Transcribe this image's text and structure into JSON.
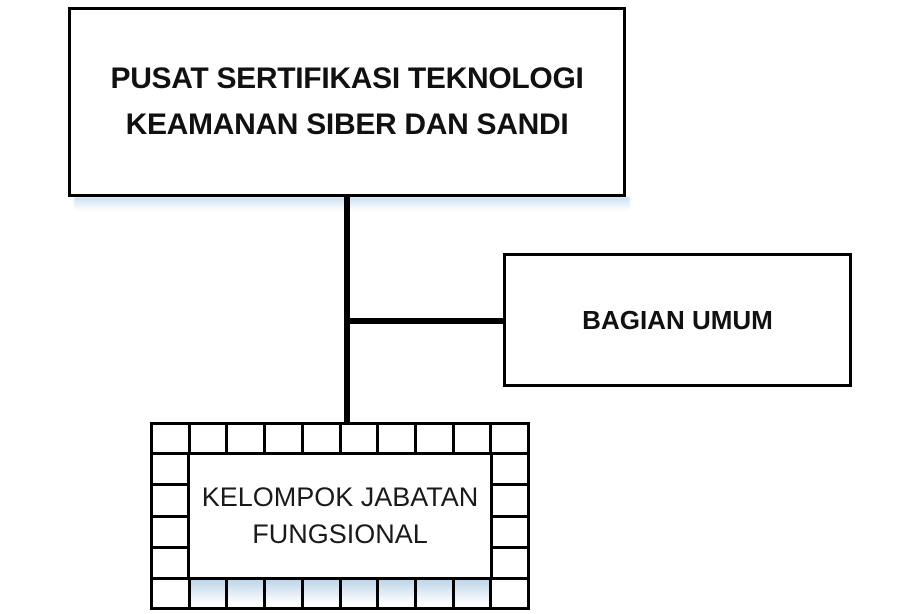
{
  "nodes": {
    "root": {
      "line1": "PUSAT SERTIFIKASI TEKNOLOGI",
      "line2": "KEAMANAN SIBER DAN SANDI"
    },
    "bagian_umum": {
      "label": "BAGIAN UMUM"
    },
    "kelompok": {
      "line1": "KELOMPOK JABATAN",
      "line2": "FUNGSIONAL"
    }
  },
  "colors": {
    "border": "#000000",
    "background": "#ffffff",
    "connector": "#000000",
    "shadow_blue": "#c6dbee"
  },
  "frame": {
    "top_cells": 10,
    "bottom_cells": 10,
    "side_cells": 4,
    "shadow_cells_from": 1,
    "shadow_cells_to": 8
  }
}
